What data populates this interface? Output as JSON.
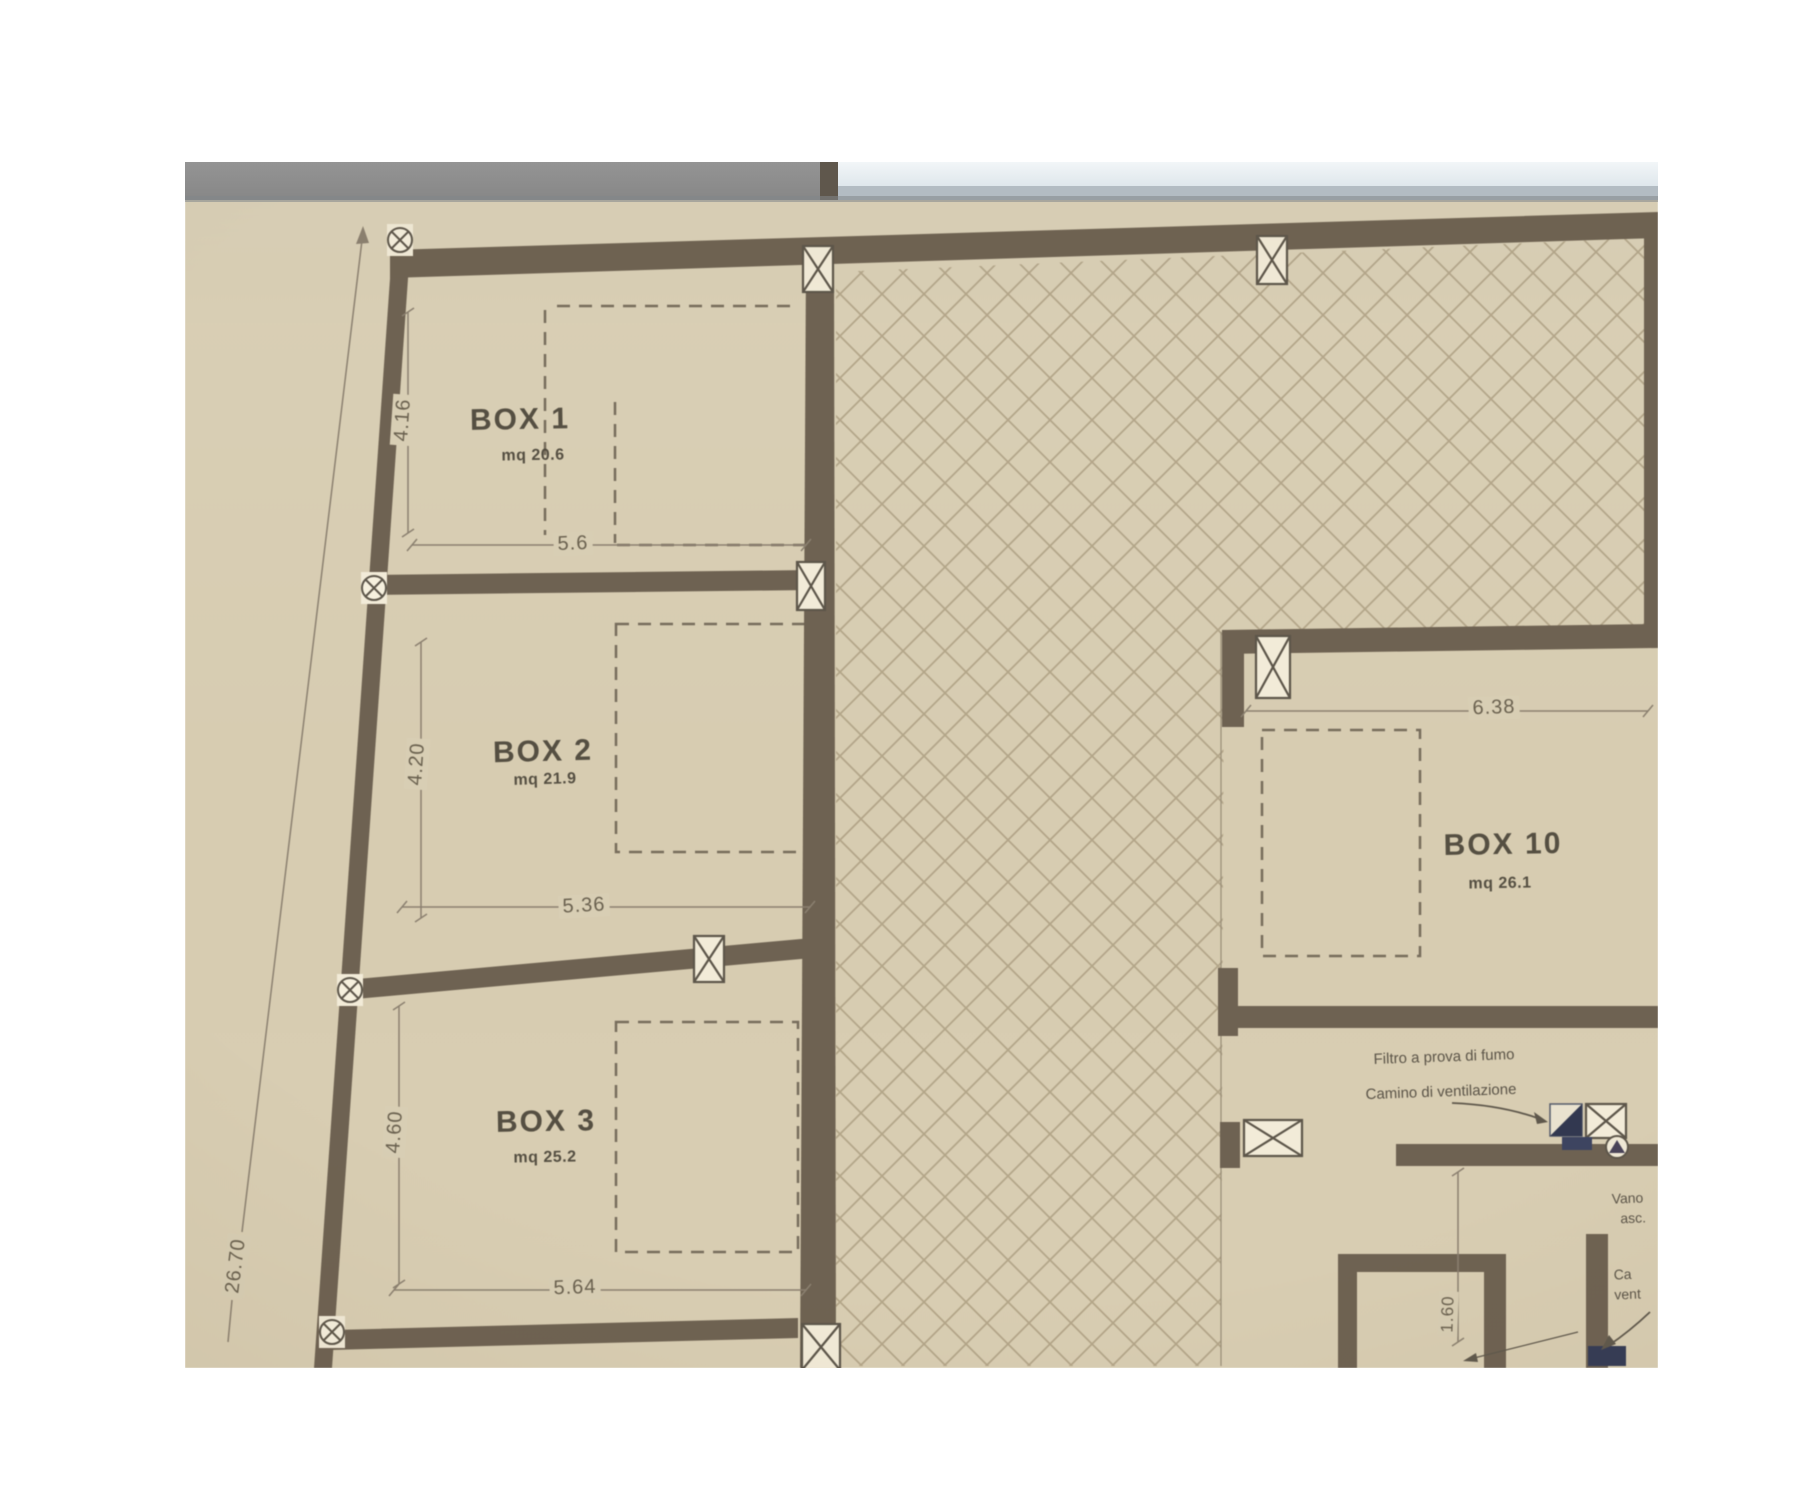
{
  "plan": {
    "boxes": [
      {
        "label": "BOX 1",
        "area": "mq 20.6",
        "width": "5.6",
        "depth": "4.16"
      },
      {
        "label": "BOX 2",
        "area": "mq 21.9",
        "width": "5.36",
        "depth": "4.20"
      },
      {
        "label": "BOX 3",
        "area": "mq 25.2",
        "width": "5.64",
        "depth": "4.60"
      },
      {
        "label": "BOX 10",
        "area": "mq 26.1",
        "width": "6.38"
      }
    ],
    "overall_dimension": "26.70",
    "shaft_dimension": "1.60",
    "notes": {
      "filtro": "Filtro a prova di fumo",
      "camino": "Camino di ventilazione",
      "vano_line1": "Vano",
      "vano_line2": "asc.",
      "camino2_line1": "Ca",
      "camino2_line2": "vent"
    }
  },
  "colors": {
    "paper": "#ffffff",
    "plan_background": "#d8ceb4",
    "wall": "#6e6252",
    "hatch_line": "#a09173",
    "dashed_line": "#776d5c",
    "dimension_line": "#8b8070",
    "text": "#4a4438",
    "chrome_bar_dark": "#8d8d8d",
    "chrome_bar_light": "#e9eff2",
    "symbol_dark": "#323850"
  },
  "icons": [
    "column-circle-x-marker",
    "column-crossed-box-marker",
    "smoke-filter-marker",
    "vent-shaft-marker"
  ]
}
